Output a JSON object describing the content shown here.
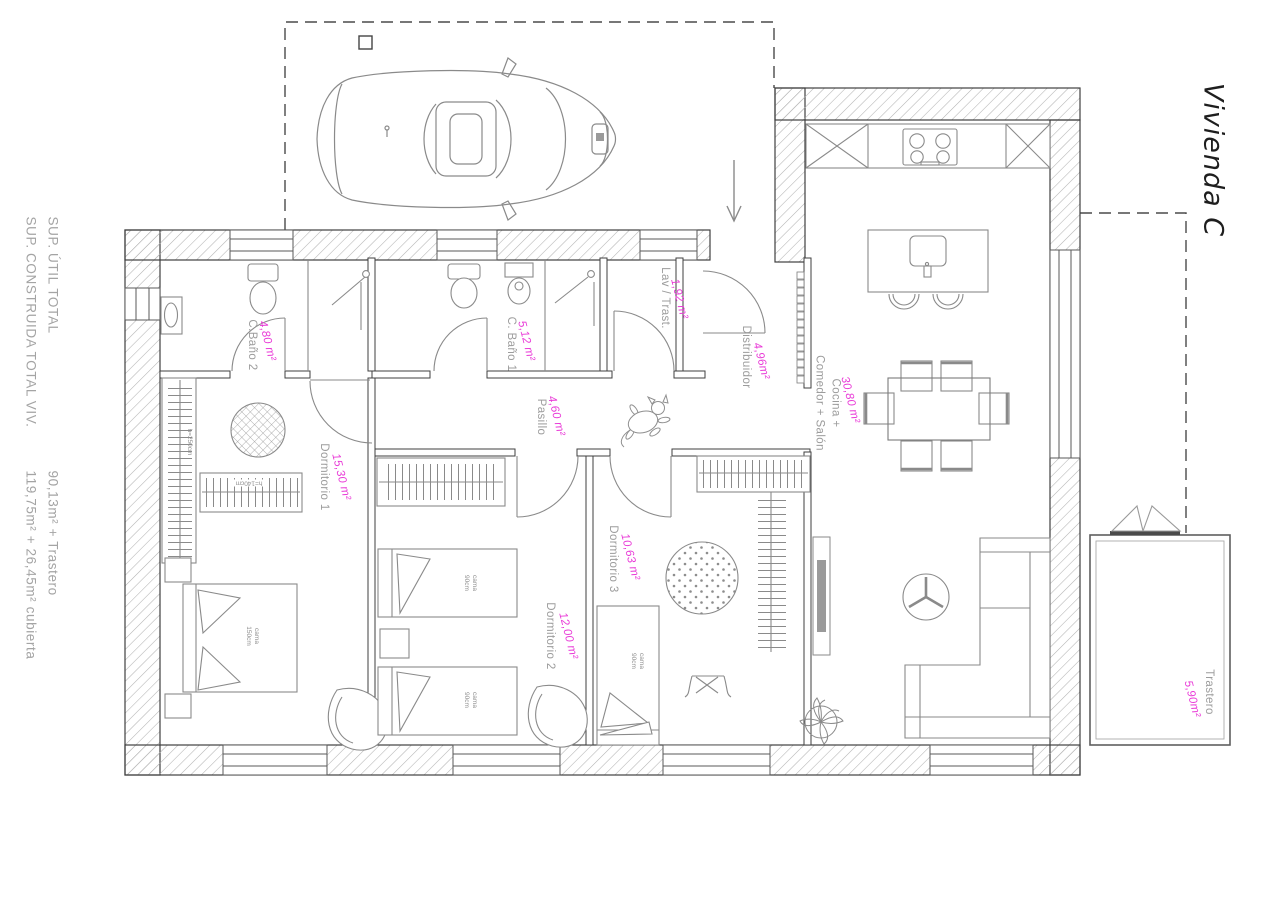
{
  "title": "Vivienda C",
  "summary": {
    "line1_label": "SUP. ÚTIL TOTAL",
    "line2_label": "SUP. CONSTRUIDA TOTAL VIV.",
    "line1_value": "90,13m² + Trastero",
    "line2_value": "119,75m² + 26,45m² cubierta"
  },
  "rooms": [
    {
      "id": "bano2",
      "name": "C.Baño 2",
      "area": "4,80 m²"
    },
    {
      "id": "bano1",
      "name": "C. Baño 1",
      "area": "5,12 m²"
    },
    {
      "id": "lavadero",
      "name": "Lav / Trast.",
      "area": "1,92 m²"
    },
    {
      "id": "distribuidor",
      "name": "Distribuidor",
      "area": "4,96m²"
    },
    {
      "id": "pasillo",
      "name": "Pasillo",
      "area": "4,60 m²"
    },
    {
      "id": "dormitorio1",
      "name": "Dormitorio 1",
      "area": "15,30 m²"
    },
    {
      "id": "dormitorio2",
      "name": "Dormitorio 2",
      "area": "12,00 m²"
    },
    {
      "id": "dormitorio3",
      "name": "Dormitorio 3",
      "area": "10,63 m²"
    },
    {
      "id": "salon",
      "name": "Cocina +\nComedor + Salón",
      "area": "30,80 m²"
    },
    {
      "id": "trastero",
      "name": "Trastero",
      "area": "5,90m²"
    }
  ],
  "furniture_labels": {
    "bed_150": "cama\n150cm",
    "bed_90": "cama\n90cm",
    "wardrobe_h250": "h=250cm",
    "wardrobe_h140": "h=140cm"
  },
  "colors": {
    "area_magenta": "#e93ad7",
    "label_gray": "#9c9c9c",
    "wall_line": "#3f3f3f",
    "hatch_gray": "#b3b3b3",
    "furniture_gray": "#8a8a8a"
  }
}
